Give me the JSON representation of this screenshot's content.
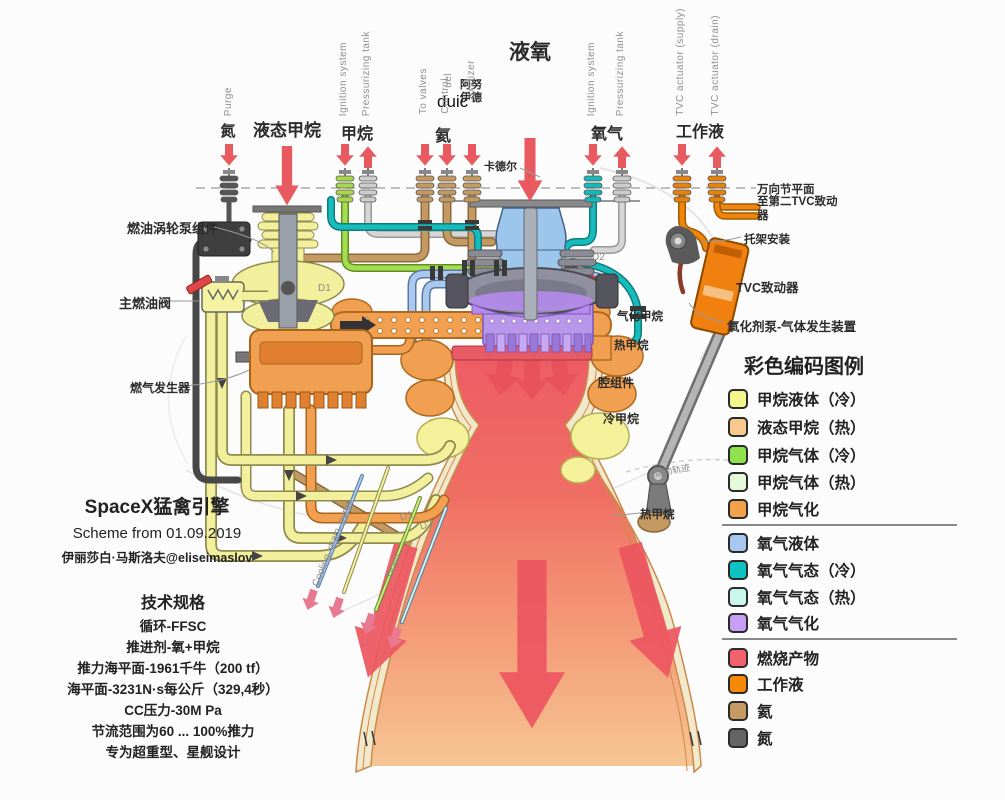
{
  "top": {
    "nitrogen": "氮",
    "liquid_methane": "液态甲烷",
    "methane": "甲烷",
    "helium": "氦",
    "lox": "液氧",
    "oxygen": "氧气",
    "working_fluid": "工作液",
    "purge": "Purge",
    "ignition_system": "Ignition system",
    "pressurizing_tank": "Pressurizing tank",
    "to_valves": "To valves",
    "control": "Control",
    "uel": "uel",
    "duic": "duic",
    "anuide": "阿努伊德",
    "oxidizer": "oxidizer",
    "ignition_system_2": "Ignition system",
    "pressurizing_tank_2": "Pressurizing tank",
    "tvc_supply": "TVC actuator (supply)",
    "tvc_drain": "TVC actuator (drain)"
  },
  "callouts": {
    "fuel_turbopump_assembly": "燃油涡轮泵组件",
    "main_fuel_valve": "主燃油阀",
    "gas_generator": "燃气发生器",
    "kardel": "卡德尔",
    "d1_top": "D1",
    "d2_top": "D2",
    "gimbal_plane": "万向节平面",
    "to_second_tvc_actuator": "至第二TVC致动器",
    "bracket_mount": "托架安装",
    "tvc_actuator": "TVC致动器",
    "oxidizer_pump_gas_generator": "氧化剂泵-气体发生装置",
    "vaporized_methane": "气化甲烷",
    "hot_methane_upper": "热甲烷",
    "chamber_assembly": "腔组件",
    "cold_methane": "冷甲烷",
    "motion_trajectory": "运动轨迹",
    "hot_methane_lower": "热甲烷",
    "cooling_drain_purge": "Cooling, drain, purge",
    "drain": "Drain",
    "d1_bottom": "D1",
    "d2_bottom": "D2"
  },
  "title_block": {
    "line1": "SpaceX猛禽引擎",
    "line2": "Scheme from 01.09.2019",
    "line3": "伊丽莎白·马斯洛夫@eliseimaslov"
  },
  "specs": {
    "title": "技术规格",
    "lines": [
      "循环-FFSC",
      "推进剂-氧+甲烷",
      "推力海平面-1961千牛（200 tf）",
      "海平面-3231N·s每公斤（329,4秒）",
      "CC压力-30M Pa",
      "节流范围为60 ... 100%推力",
      "专为超重型、星舰设计"
    ]
  },
  "legend": {
    "title": "彩色编码图例",
    "items": [
      {
        "label": "甲烷液体（冷）",
        "color": "#f3f58d"
      },
      {
        "label": "液态甲烷（热）",
        "color": "#f8c98e"
      },
      {
        "label": "甲烷气体（冷）",
        "color": "#90e24d"
      },
      {
        "label": "甲烷气体（热）",
        "color": "#e7f7da"
      },
      {
        "label": "甲烷气化",
        "color": "#f2a24b"
      },
      {
        "label": "氧气液体",
        "color": "#a6c8f0"
      },
      {
        "label": "氧气气态（冷）",
        "color": "#10c3c3"
      },
      {
        "label": "氧气气态（热）",
        "color": "#c9f7ee"
      },
      {
        "label": "氧气气化",
        "color": "#c89ef4"
      },
      {
        "label": "燃烧产物",
        "color": "#f2616e"
      },
      {
        "label": "工作液",
        "color": "#f78908"
      },
      {
        "label": "氦",
        "color": "#c69b63"
      },
      {
        "label": "氮",
        "color": "#646464"
      }
    ]
  }
}
